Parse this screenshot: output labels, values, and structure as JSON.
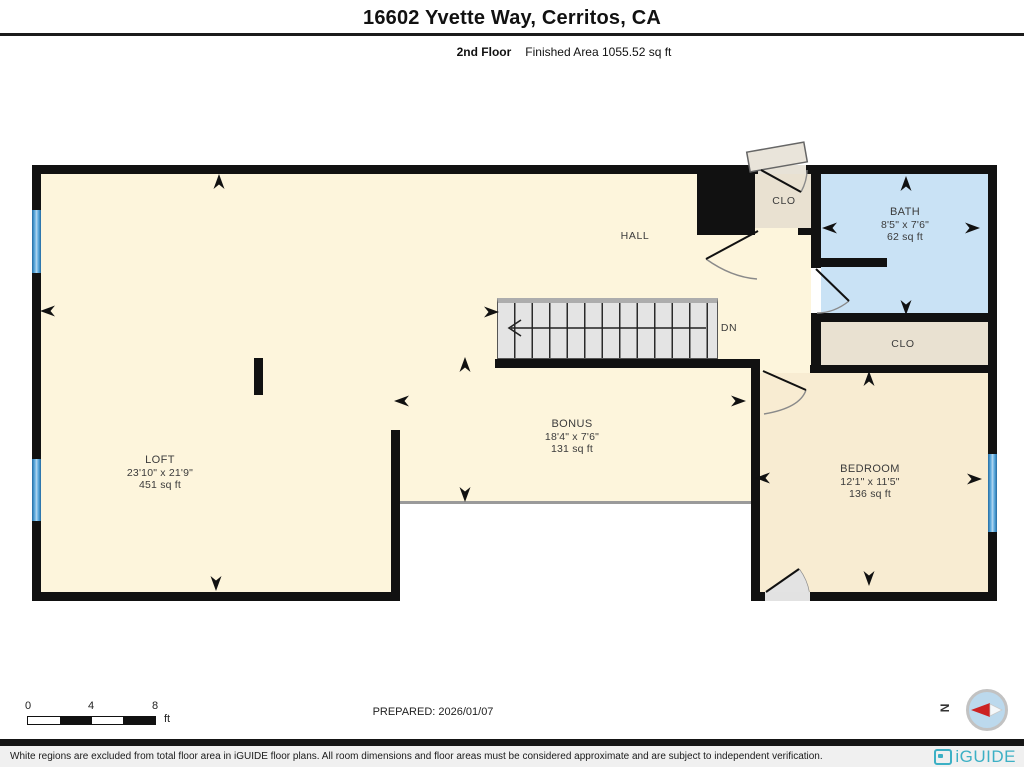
{
  "header": {
    "title": "16602 Yvette Way, Cerritos, CA",
    "floor": "2nd Floor",
    "finished_area": "Finished Area 1055.52 sq ft"
  },
  "plan": {
    "rooms": {
      "loft": {
        "name": "LOFT",
        "dims": "23'10\" x 21'9\"",
        "area": "451 sq ft"
      },
      "hall": {
        "name": "HALL"
      },
      "bonus": {
        "name": "BONUS",
        "dims": "18'4\" x 7'6\"",
        "area": "131 sq ft"
      },
      "bath": {
        "name": "BATH",
        "dims": "8'5\" x 7'6\"",
        "area": "62 sq ft"
      },
      "bedroom": {
        "name": "BEDROOM",
        "dims": "12'1\" x 11'5\"",
        "area": "136 sq ft"
      },
      "closet_top": {
        "name": "CLO"
      },
      "closet_bath": {
        "name": "CLO"
      }
    },
    "stairs_label": "DN",
    "colors": {
      "wall": "#111111",
      "floor_cream": "#fdf5dc",
      "bedroom_cream": "#f8ecd2",
      "bath_blue": "#c9e2f5",
      "closet_beige": "#e9e1d1",
      "window_blue": "#4f9ecf"
    }
  },
  "scale_bar": {
    "ticks": [
      "0",
      "4",
      "8"
    ],
    "unit": "ft"
  },
  "prepared": "PREPARED: 2026/01/07",
  "compass": {
    "label": "N"
  },
  "footer": {
    "disclaimer": "White regions are excluded from total floor area in iGUIDE floor plans. All room dimensions and floor areas must be considered approximate and are subject to independent verification.",
    "brand": "iGUIDE",
    "brand_color": "#3cb0c5"
  }
}
